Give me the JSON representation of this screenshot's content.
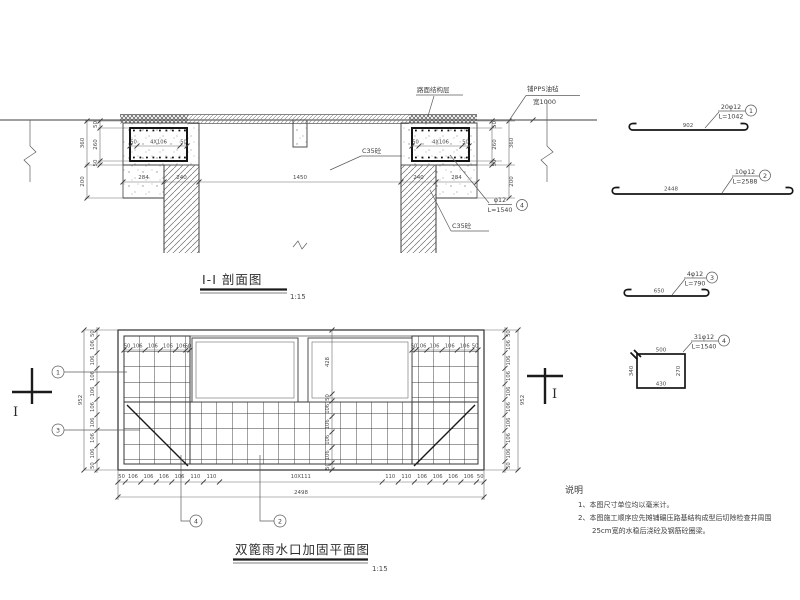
{
  "section": {
    "title": "I-I 剖面图",
    "scale": "1:15",
    "labels": {
      "road_layer": "路面结构层",
      "pps_sheet": "铺PPS油毡",
      "pps_width": "宽1000",
      "c35_left": "C35砼",
      "c35_right": "C35砼",
      "rebar_spec": "φ12",
      "rebar_len": "L=1540"
    },
    "dims": {
      "inner": [
        "50",
        "260",
        "50"
      ],
      "outer_height": "360",
      "below": "200",
      "left": [
        "284",
        "240"
      ],
      "span": "1450",
      "right": [
        "240",
        "284"
      ],
      "collar_chain": [
        "50",
        "4X106",
        "50"
      ]
    }
  },
  "plan": {
    "title": "双篦雨水口加固平面图",
    "scale": "1:15",
    "section_mark": "I",
    "bottom_chain": [
      "50",
      "106",
      "106",
      "106",
      "106",
      "110",
      "110",
      "10X111",
      "110",
      "110",
      "106",
      "106",
      "106",
      "106",
      "50"
    ],
    "bottom_total": "2498",
    "side_chain": [
      "50",
      "106",
      "106",
      "106",
      "106",
      "106",
      "106",
      "106",
      "106",
      "50"
    ],
    "side_total": "952",
    "block_top_chain": [
      "50",
      "106",
      "106",
      "106",
      "106",
      "50"
    ],
    "opening_height": "428",
    "center_chain": [
      "50",
      "106",
      "106",
      "106",
      "106",
      "50"
    ]
  },
  "details": [
    {
      "spec": "20φ12",
      "length": "L=1042",
      "bar_length": "902"
    },
    {
      "spec": "10φ12",
      "length": "L=2588",
      "bar_length": "2448"
    },
    {
      "spec": "4φ12",
      "length": "L=790",
      "bar_length": "650"
    },
    {
      "spec": "31φ12",
      "length": "L=1540",
      "top": "500",
      "left_side": "340",
      "bottom": "430",
      "right_side": "270"
    }
  ],
  "callouts": {
    "n1": "1",
    "n2": "2",
    "n3": "3",
    "n4": "4"
  },
  "notes": {
    "heading": "说明",
    "line1": "1、本图尺寸单位均以毫米计。",
    "line2": "2、本图施工顺序应先摊铺碾压路基结构成型后切除检查井周围",
    "line3": "25cm宽的水稳后浇砼及钢筋砼圈梁。"
  }
}
